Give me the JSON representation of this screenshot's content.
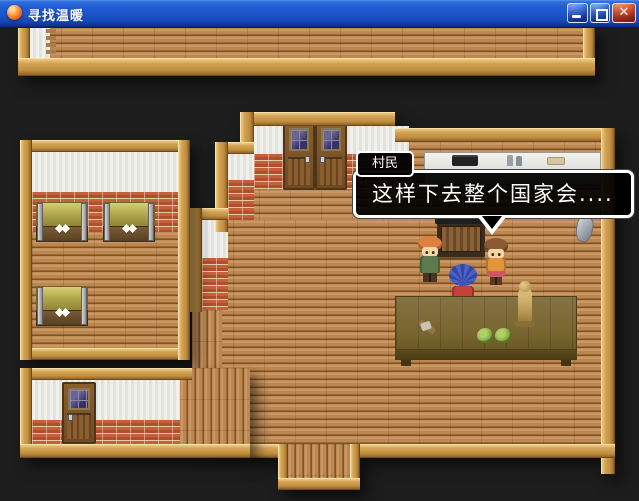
{
  "window": {
    "title": "寻找温暖",
    "controls": {
      "close_glyph": "✕"
    },
    "icons": {
      "app": "app-icon",
      "minimize": "minimize-icon",
      "maximize": "maximize-icon",
      "close": "close-icon"
    }
  },
  "dialogue": {
    "speaker_name": "村民",
    "text": "这样下去整个国家会...."
  },
  "colors": {
    "titlebar_blue": "#1b54c8",
    "close_button_red": "#cf3a18",
    "background_dark": "#1d1d1d",
    "wood_floor": "#bd8750",
    "wood_frame": "#d2a253",
    "brick_wall": "#b85430",
    "white_wall": "#eaeae6",
    "chest_lid_olive": "#b3a94c",
    "table_khaki": "#78652f",
    "dialog_background": "#000000",
    "dialog_border": "#ffffff"
  }
}
